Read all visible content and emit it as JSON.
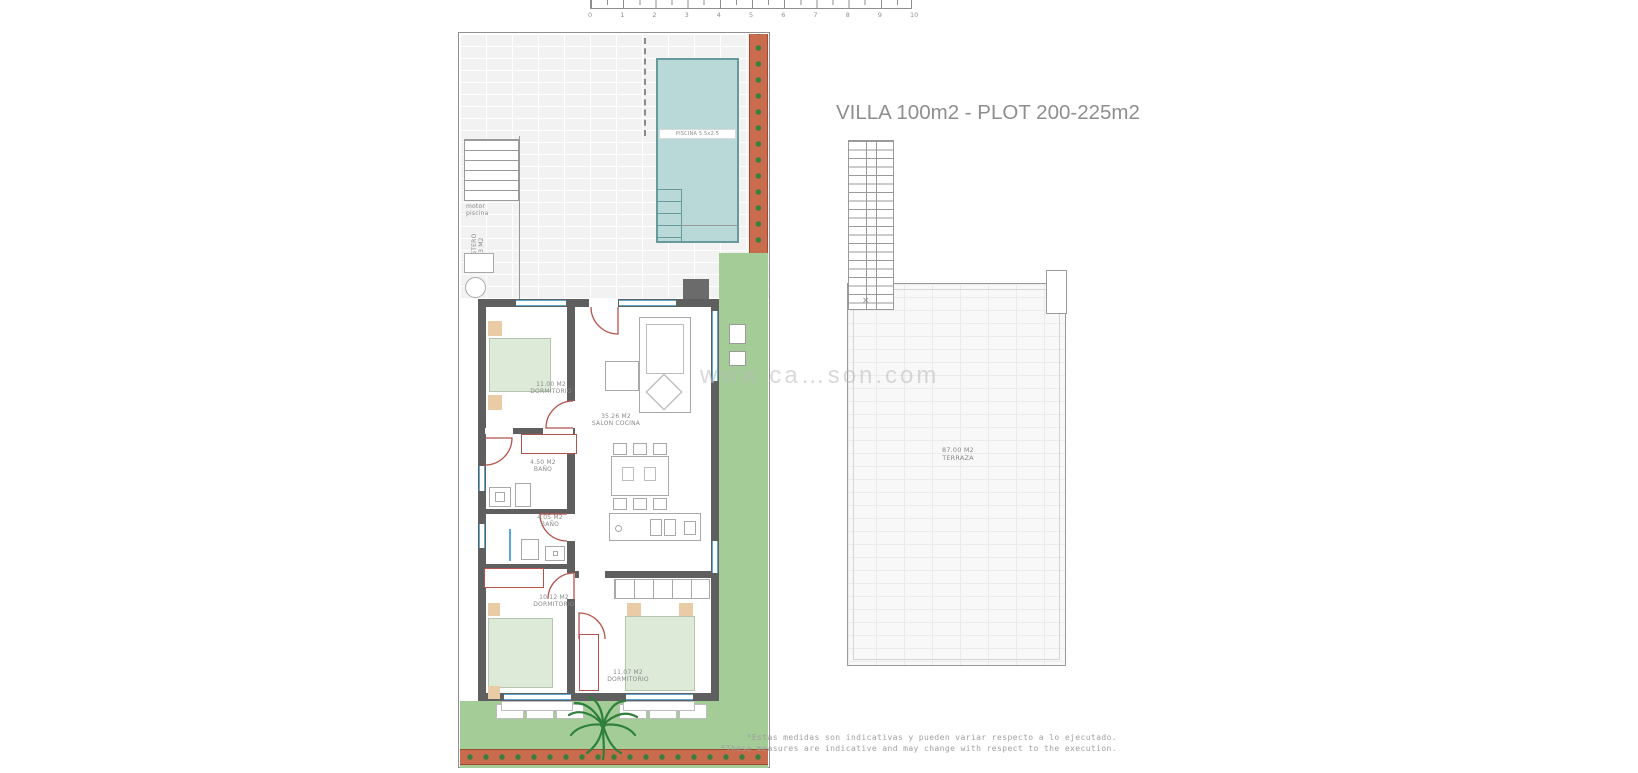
{
  "title": "VILLA 100m2 - PLOT 200-225m2",
  "watermark": "www.ca…son.com",
  "scale_bar": {
    "unit_labels": [
      "0",
      "1",
      "2",
      "3",
      "4",
      "5",
      "6",
      "7",
      "8",
      "9",
      "10"
    ]
  },
  "ground_plan": {
    "pool": {
      "label": "PISCINA 5.5x2.5"
    },
    "pool_motor": {
      "line1": "motor",
      "line2": "piscina"
    },
    "storage": {
      "line1": "TRASTERO",
      "line2": "2.73 M2"
    },
    "rooms": [
      {
        "id": "dormitorio-1",
        "area": "11.00 M2",
        "name": "DORMITORIO"
      },
      {
        "id": "salon-cocina",
        "area": "35.26 M2",
        "name": "SALON COCINA"
      },
      {
        "id": "bano-1",
        "area": "4.50 M2",
        "name": "BAÑO"
      },
      {
        "id": "bano-2",
        "area": "4.05 M2",
        "name": "BAÑO"
      },
      {
        "id": "dormitorio-2",
        "area": "10.12 M2",
        "name": "DORMITORIO"
      },
      {
        "id": "dormitorio-3",
        "area": "11.07 M2",
        "name": "DORMITORIO"
      }
    ]
  },
  "roof_plan": {
    "terrace": {
      "area": "87.00 M2",
      "name": "TERRAZA"
    }
  },
  "disclaimer": {
    "line_es": "*Estas medidas son indicativas y pueden variar respecto a lo ejecutado.",
    "line_en": "*These measures are indicative and may change with respect to the execution."
  },
  "colors": {
    "wall": "#5f5f5f",
    "pool": "#b9d9d9",
    "garden": "#a3cc97",
    "terracotta": "#c96b4d",
    "plant_green": "#3c7d3e",
    "door_red": "#b5524b",
    "window_blue": "#58a8d8",
    "bed_green": "#dcead7",
    "furniture_tan": "#e9cba6",
    "text_gray": "#8a8a8a"
  }
}
